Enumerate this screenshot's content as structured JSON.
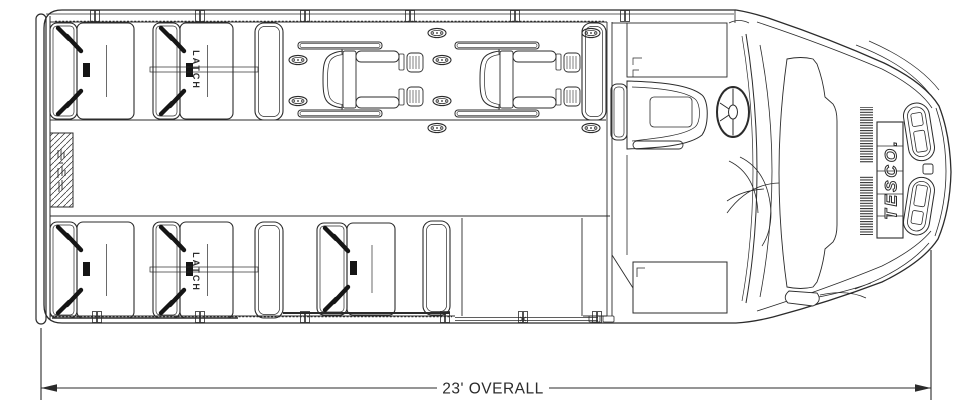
{
  "document": {
    "type": "bus-floor-plan-drawing",
    "background": "#ffffff",
    "line_color": "#2b2b2b",
    "belt_color": "#151515"
  },
  "labels": {
    "latch": "LATCH",
    "brand": "TESCO.",
    "overall_dimension": "23' OVERALL"
  },
  "floorplan": {
    "passenger_seats": [
      {
        "x": 50,
        "y": 23,
        "backW": 27,
        "cushW": 57,
        "h": 96
      },
      {
        "x": 153,
        "y": 23,
        "backW": 27,
        "cushW": 53,
        "h": 96
      },
      {
        "x": 50,
        "y": 222,
        "backW": 27,
        "cushW": 57,
        "h": 96
      },
      {
        "x": 153,
        "y": 222,
        "backW": 27,
        "cushW": 53,
        "h": 96
      },
      {
        "x": 317,
        "y": 223,
        "backW": 30,
        "cushW": 48,
        "h": 92
      }
    ],
    "seat_barriers": [
      {
        "x": 255,
        "y": 23,
        "w": 28,
        "h": 97
      },
      {
        "x": 582,
        "y": 23,
        "w": 24,
        "h": 97
      },
      {
        "x": 255,
        "y": 222,
        "w": 28,
        "h": 96
      },
      {
        "x": 423,
        "y": 221,
        "w": 27,
        "h": 94
      }
    ],
    "wheelchair_positions": [
      {
        "x": 298,
        "y": 42
      },
      {
        "x": 455,
        "y": 42
      }
    ],
    "floor_anchors": [
      {
        "x": 437,
        "y": 33
      },
      {
        "x": 591,
        "y": 33
      },
      {
        "x": 298,
        "y": 60
      },
      {
        "x": 442,
        "y": 60
      },
      {
        "x": 298,
        "y": 101
      },
      {
        "x": 442,
        "y": 101
      },
      {
        "x": 437,
        "y": 128
      },
      {
        "x": 591,
        "y": 128
      }
    ],
    "wall_ticks_top": [
      95,
      200,
      305,
      410,
      515,
      625
    ],
    "wall_ticks_bottom": [
      97,
      200,
      305,
      445,
      523,
      597
    ]
  }
}
